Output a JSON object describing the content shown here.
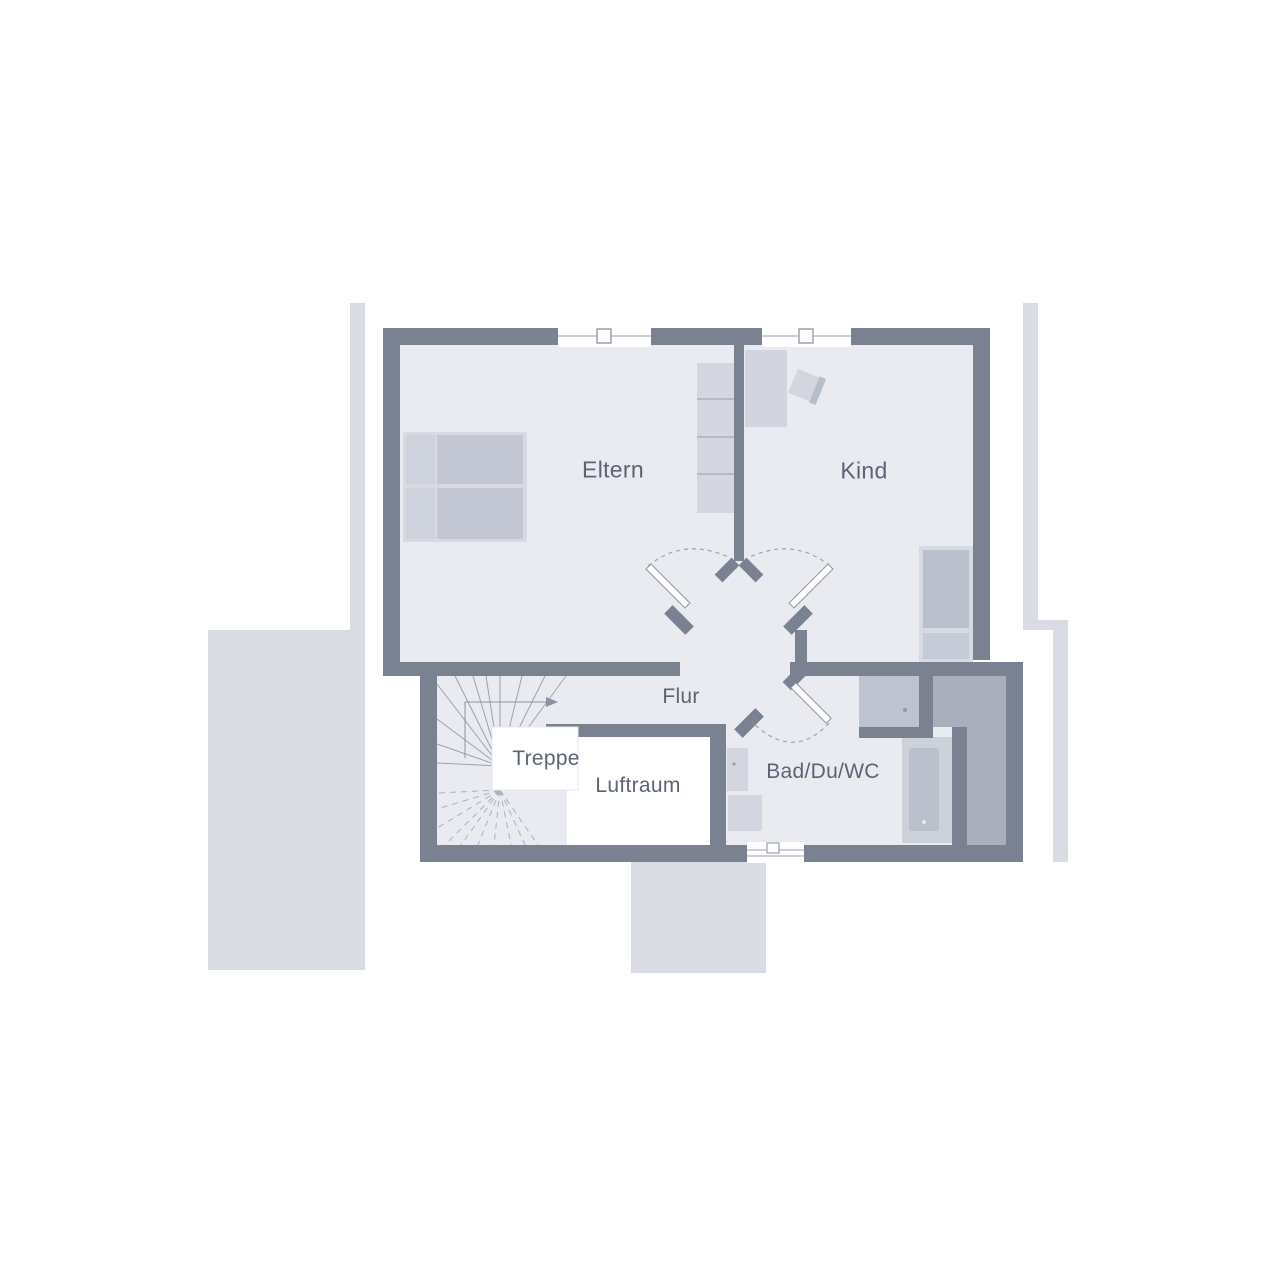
{
  "rooms": {
    "eltern": "Eltern",
    "kind": "Kind",
    "flur": "Flur",
    "treppe": "Treppe",
    "luftraum": "Luftraum",
    "bad": "Bad/Du/WC"
  },
  "colors": {
    "wall": "#7a8292",
    "floor": "#e9ebf1",
    "outside_shapes": "#dadce3",
    "void_white": "#ffffff",
    "furniture_light": "#d7dae2",
    "furniture_mid": "#c2c7d3",
    "furniture_dark": "#b9bfcb",
    "storage_fill": "#a9aebc",
    "shower_fill": "#bec3d0",
    "stair_line": "#9aa2b1",
    "label_text": "#5c6375"
  }
}
